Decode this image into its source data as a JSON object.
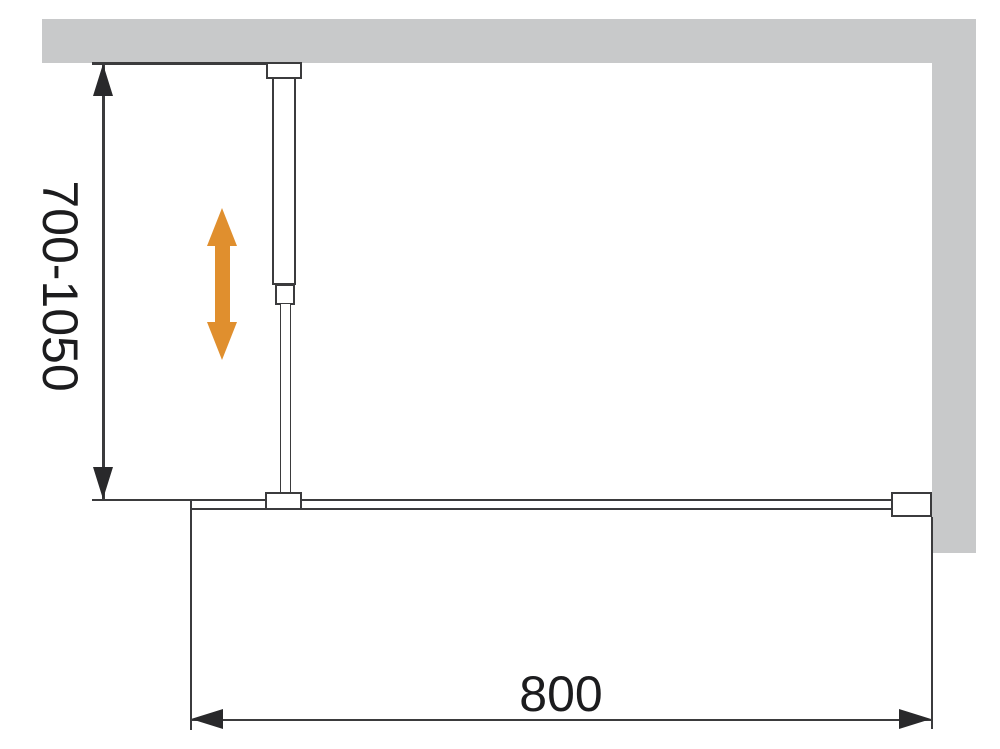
{
  "diagram": {
    "name": "walk-in-shower-screen-installation-drawing",
    "labels": {
      "support_bar_range": "700-1050",
      "panel_width": "800"
    },
    "colors": {
      "background": "#ffffff",
      "wall": "#c8c9ca",
      "line": "#3b3b3d",
      "arrow": "#29292b",
      "text": "#1c1c1e",
      "accent-orange": "#e08f2e"
    },
    "icons": [
      "height-adjust-arrow-icon"
    ]
  }
}
